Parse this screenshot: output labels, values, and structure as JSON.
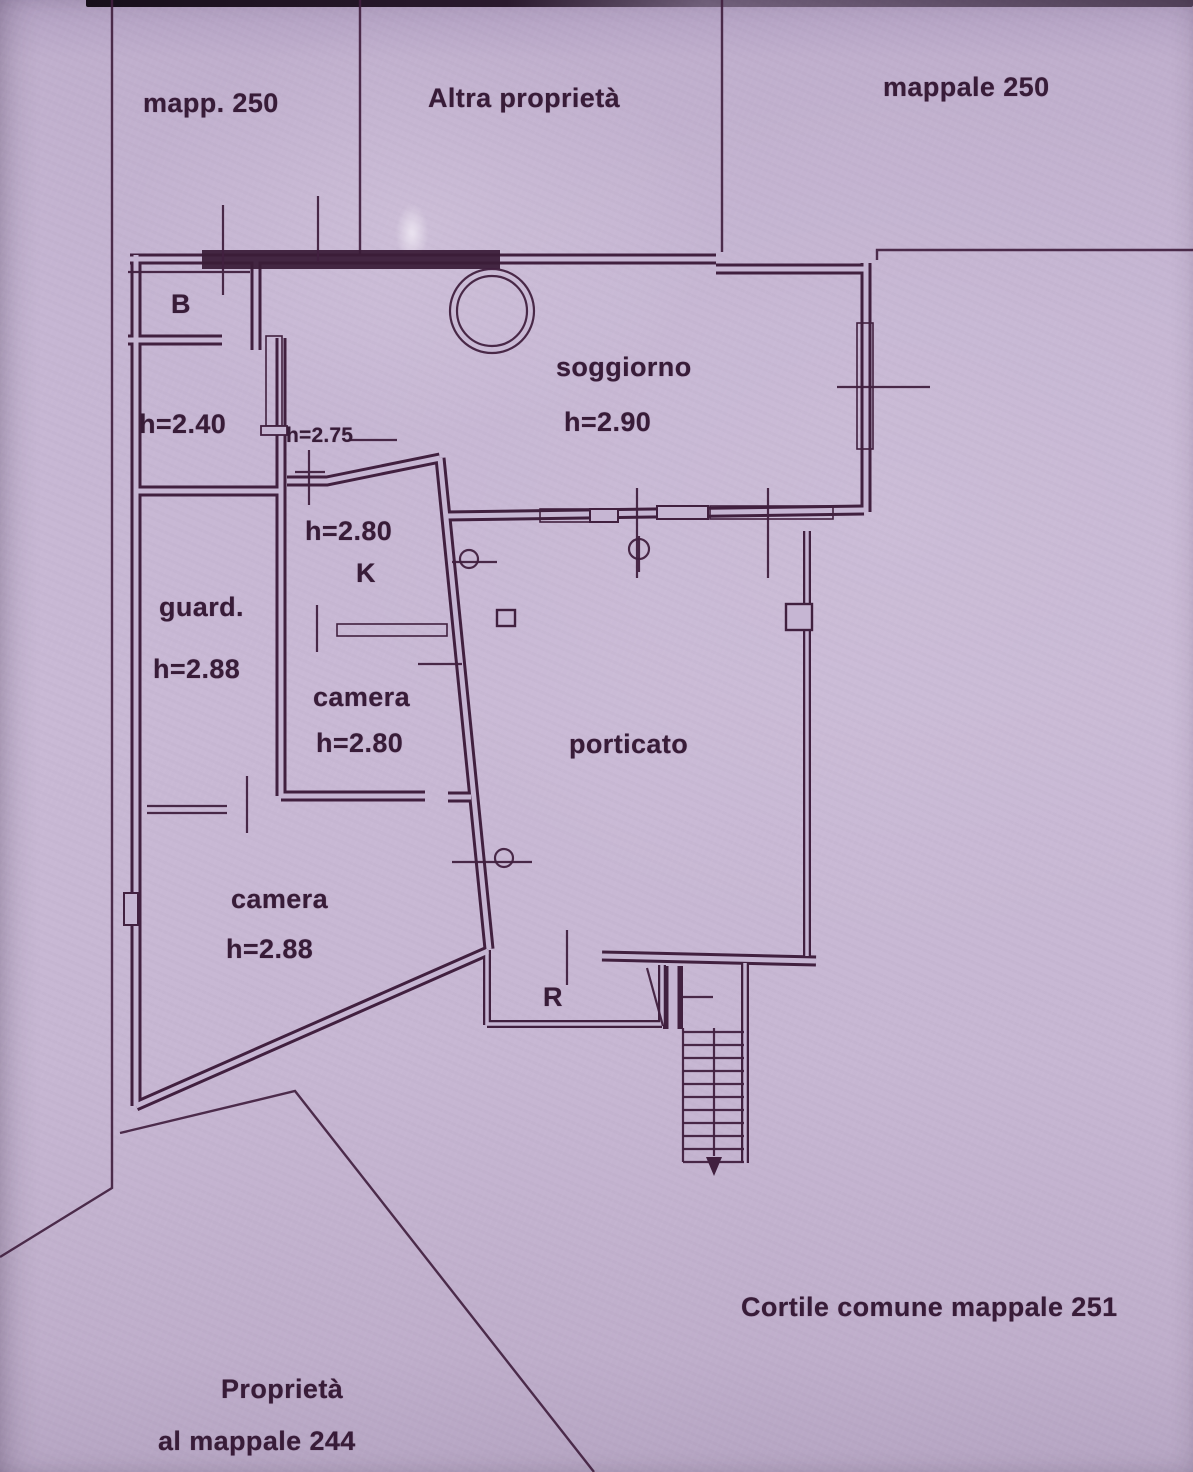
{
  "colors": {
    "paper": "#c6b6d3",
    "ink": "#41203f",
    "text": "#381c38"
  },
  "parcel_labels": {
    "top_left": "mapp. 250",
    "top_center": "Altra proprietà",
    "top_right": "mappale 250",
    "courtyard_bottom_right": "Cortile comune mappale 251",
    "bottom_left_line1": "Proprietà",
    "bottom_left_line2": "al mappale 244"
  },
  "room_labels": {
    "bath": "B",
    "bath_height": "h=2.40",
    "hallway_height": "h=2.75",
    "living_room": "soggiorno",
    "living_room_height": "h=2.90",
    "kitchen": "K",
    "kitchen_height": "h=2.80",
    "closet": "guard.",
    "closet_height": "h=2.88",
    "bedroom1": "camera",
    "bedroom1_height": "h=2.80",
    "porch": "porticato",
    "bedroom2": "camera",
    "bedroom2_height": "h=2.88",
    "entry": "R"
  }
}
